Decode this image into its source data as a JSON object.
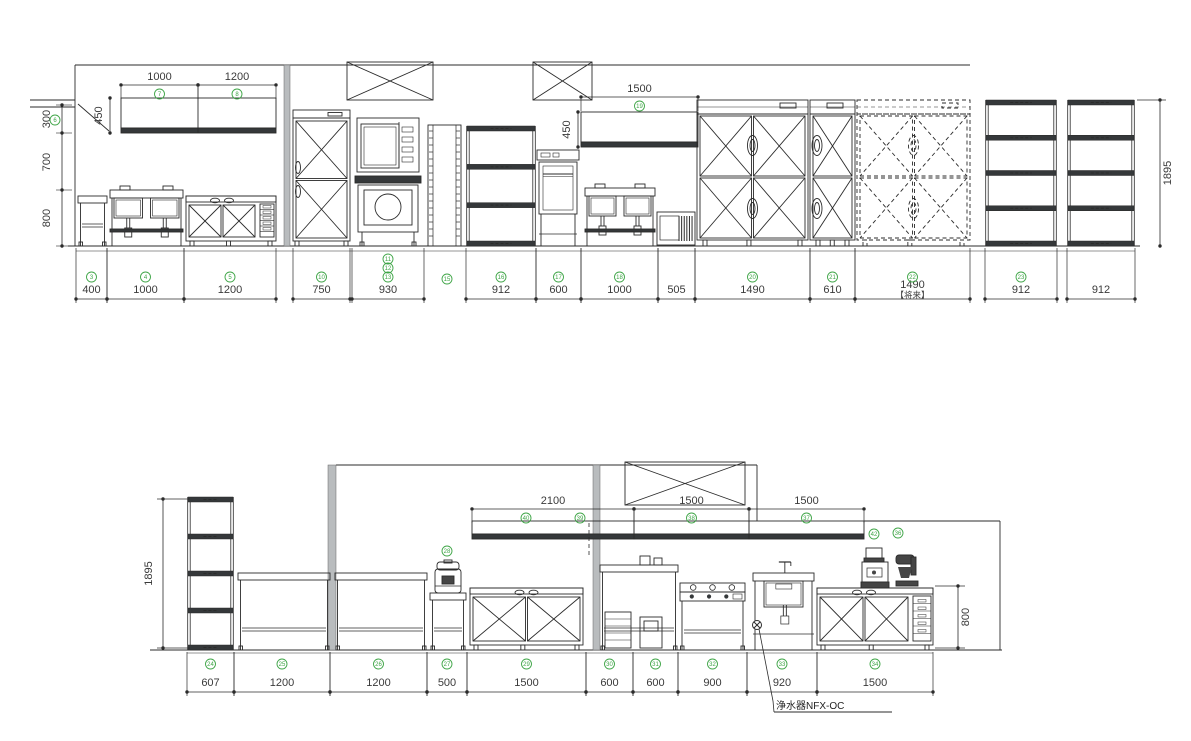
{
  "style": {
    "line_color": "#2b2b2b",
    "dim_text_color": "#3a3a3a",
    "circle_color": "#3fa547",
    "column_fill": "#b9bcbe",
    "band_fill": "#35383a",
    "background": "#ffffff"
  },
  "top_elevation": {
    "floor_y": 246,
    "dims_bottom": {
      "line_y": 299,
      "label_y": 293,
      "circle_y": 277,
      "items": [
        {
          "v": "400",
          "c": [
            "3"
          ],
          "x1": 76,
          "x2": 107
        },
        {
          "v": "1000",
          "c": [
            "4"
          ],
          "x1": 107,
          "x2": 184
        },
        {
          "v": "1200",
          "c": [
            "5"
          ],
          "x1": 184,
          "x2": 276
        },
        {
          "v": "750",
          "c": [
            "10"
          ],
          "x1": 293,
          "x2": 350
        },
        {
          "v": "930",
          "c": [
            "11",
            "12",
            "13"
          ],
          "x1": 352,
          "x2": 424
        },
        {
          "v": "912",
          "c": [
            "16"
          ],
          "x1": 466,
          "x2": 536
        },
        {
          "v": "600",
          "c": [
            "17"
          ],
          "x1": 536,
          "x2": 581
        },
        {
          "v": "1000",
          "c": [
            "18"
          ],
          "x1": 581,
          "x2": 658
        },
        {
          "v": "505",
          "c": [],
          "x1": 658,
          "x2": 695
        },
        {
          "v": "1490",
          "c": [
            "20"
          ],
          "x1": 695,
          "x2": 810
        },
        {
          "v": "610",
          "c": [
            "21"
          ],
          "x1": 810,
          "x2": 855
        },
        {
          "v": "1490",
          "c": [
            "22"
          ],
          "sub": "【将来】",
          "x1": 855,
          "x2": 970
        },
        {
          "v": "912",
          "c": [
            "23"
          ],
          "x1": 985,
          "x2": 1057
        },
        {
          "v": "912",
          "c": [],
          "x1": 1067,
          "x2": 1135
        }
      ]
    },
    "dims_top": [
      {
        "v": "1000",
        "c": [
          "7"
        ],
        "x1": 121,
        "x2": 198,
        "y": 85
      },
      {
        "v": "1200",
        "c": [
          "8"
        ],
        "x1": 198,
        "x2": 276,
        "y": 85
      },
      {
        "v": "1500",
        "c": [
          "19"
        ],
        "x1": 581,
        "x2": 698,
        "y": 97
      }
    ],
    "dims_vertical": [
      {
        "v": "450",
        "x": 110,
        "y1": 98,
        "y2": 133,
        "tx": 102
      },
      {
        "v": "450",
        "x": 578,
        "y1": 112,
        "y2": 147,
        "tx": 570
      },
      {
        "v": "1895",
        "x": 1160,
        "y1": 100,
        "y2": 246,
        "tx": 1171,
        "leaders": [
          [
            1137,
            100,
            1166,
            100
          ]
        ]
      }
    ],
    "chain_left": {
      "x": 62,
      "tx": 50,
      "ticks": [
        105,
        133,
        190,
        246
      ],
      "labels": [
        {
          "v": "300",
          "y": 119
        },
        {
          "v": "700",
          "y": 162
        },
        {
          "v": "800",
          "y": 218
        }
      ]
    },
    "leader_circle": {
      "n": "6",
      "x": 55,
      "y": 120
    },
    "floating_circles": [
      {
        "n": "15",
        "x": 447,
        "y": 279
      }
    ],
    "units": [
      {
        "t": "line",
        "x1": 75,
        "y1": 65,
        "x2": 970,
        "y2": 65
      },
      {
        "t": "line",
        "x1": 75,
        "y1": 65,
        "x2": 75,
        "y2": 246
      },
      {
        "t": "line",
        "x1": 68,
        "y1": 246,
        "x2": 1140,
        "y2": 246
      },
      {
        "t": "line",
        "x1": 76,
        "y1": 251,
        "x2": 1135,
        "y2": 251,
        "lw": 0.6
      },
      {
        "t": "hatch",
        "x": 30,
        "y": 100
      },
      {
        "t": "line",
        "x1": 78,
        "y1": 104,
        "x2": 109,
        "y2": 131
      },
      {
        "t": "wallshelf",
        "x": 121,
        "y": 98,
        "w": 155,
        "h": 35,
        "div": [
          198
        ]
      },
      {
        "t": "table",
        "x": 78,
        "y": 196,
        "w": 29
      },
      {
        "t": "sink2",
        "x": 110,
        "y": 190,
        "w": 73
      },
      {
        "t": "fridgecounter",
        "x": 186,
        "y": 196,
        "w": 90,
        "dw": 18
      },
      {
        "t": "column",
        "x": 284,
        "y": 65,
        "w": 6,
        "h": 181
      },
      {
        "t": "fridgetall",
        "x": 293,
        "y": 110,
        "w": 57
      },
      {
        "t": "hood",
        "x": 347,
        "y": 62,
        "w": 86,
        "h": 38
      },
      {
        "t": "oven",
        "x": 355,
        "y": 118,
        "w": 66
      },
      {
        "t": "platerack",
        "x": 428,
        "y": 125,
        "w": 33,
        "h": 121
      },
      {
        "t": "rack",
        "x": 466,
        "y": 126,
        "w": 70,
        "h": 120,
        "n": 4
      },
      {
        "t": "hood",
        "x": 533,
        "y": 62,
        "w": 59,
        "h": 38
      },
      {
        "t": "dishwasher",
        "x": 537,
        "y": 150,
        "w": 42
      },
      {
        "t": "wallshelf",
        "x": 581,
        "y": 112,
        "w": 117,
        "h": 35,
        "div": []
      },
      {
        "t": "sink2",
        "x": 585,
        "y": 188,
        "w": 70
      },
      {
        "t": "icemaker",
        "x": 657,
        "y": 212,
        "w": 38,
        "h": 33
      },
      {
        "t": "fridge4",
        "x": 697,
        "y": 100,
        "w": 111,
        "cols": 2
      },
      {
        "t": "fridge4",
        "x": 810,
        "y": 100,
        "w": 45,
        "cols": 1
      },
      {
        "t": "fridge4",
        "x": 857,
        "y": 100,
        "w": 113,
        "cols": 2,
        "dashed": true
      },
      {
        "t": "rack",
        "x": 985,
        "y": 100,
        "w": 72,
        "h": 146,
        "n": 5
      },
      {
        "t": "rack",
        "x": 1067,
        "y": 100,
        "w": 68,
        "h": 146,
        "n": 5
      }
    ]
  },
  "bottom_elevation": {
    "floor_y": 650,
    "dims_bottom": {
      "line_y": 692,
      "label_y": 686,
      "circle_y": 664,
      "items": [
        {
          "v": "607",
          "c": [
            "24"
          ],
          "x1": 187,
          "x2": 234
        },
        {
          "v": "1200",
          "c": [
            "25"
          ],
          "x1": 234,
          "x2": 330
        },
        {
          "v": "1200",
          "c": [
            "26"
          ],
          "x1": 330,
          "x2": 427
        },
        {
          "v": "500",
          "c": [
            "27"
          ],
          "x1": 427,
          "x2": 467
        },
        {
          "v": "1500",
          "c": [
            "29"
          ],
          "x1": 467,
          "x2": 586
        },
        {
          "v": "600",
          "c": [
            "30"
          ],
          "x1": 586,
          "x2": 633
        },
        {
          "v": "600",
          "c": [
            "31"
          ],
          "x1": 633,
          "x2": 678
        },
        {
          "v": "900",
          "c": [
            "32"
          ],
          "x1": 678,
          "x2": 747
        },
        {
          "v": "920",
          "c": [
            "33"
          ],
          "x1": 747,
          "x2": 817
        },
        {
          "v": "1500",
          "c": [
            "34"
          ],
          "x1": 817,
          "x2": 933
        }
      ]
    },
    "dims_top": [
      {
        "v": "2100",
        "c": [
          "40",
          "39"
        ],
        "x1": 472,
        "x2": 634,
        "y": 509
      },
      {
        "v": "1500",
        "c": [
          "38"
        ],
        "x1": 634,
        "x2": 749,
        "y": 509
      },
      {
        "v": "1500",
        "c": [
          "37"
        ],
        "x1": 749,
        "x2": 864,
        "y": 509
      }
    ],
    "dims_vertical": [
      {
        "v": "1895",
        "x": 163,
        "y1": 499,
        "y2": 648,
        "tx": 152,
        "leaders": [
          [
            157,
            499,
            190,
            499
          ],
          [
            157,
            648,
            190,
            648
          ]
        ]
      },
      {
        "v": "800",
        "x": 958,
        "y1": 586,
        "y2": 648,
        "tx": 969,
        "leaders": [
          [
            935,
            586,
            965,
            586
          ],
          [
            935,
            648,
            965,
            648
          ]
        ]
      }
    ],
    "floating_circles": [
      {
        "n": "28",
        "x": 447,
        "y": 551
      },
      {
        "n": "42",
        "x": 874,
        "y": 534
      },
      {
        "n": "36",
        "x": 898,
        "y": 533
      }
    ],
    "note": {
      "text": "浄水器NFX-OC",
      "x": 776,
      "y": 709,
      "underline": [
        774,
        712,
        892,
        712
      ],
      "leader": [
        [
          759,
          629
        ],
        [
          773,
          701
        ]
      ],
      "symbol": {
        "x": 757,
        "y": 625
      }
    },
    "units": [
      {
        "t": "line",
        "x1": 336,
        "y1": 465,
        "x2": 757,
        "y2": 465
      },
      {
        "t": "line",
        "x1": 757,
        "y1": 465,
        "x2": 757,
        "y2": 521
      },
      {
        "t": "line",
        "x1": 150,
        "y1": 650,
        "x2": 1002,
        "y2": 650
      },
      {
        "t": "line",
        "x1": 187,
        "y1": 653,
        "x2": 933,
        "y2": 653,
        "lw": 0.6
      },
      {
        "t": "line",
        "x1": 864,
        "y1": 521,
        "x2": 1000,
        "y2": 521
      },
      {
        "t": "line",
        "x1": 1000,
        "y1": 521,
        "x2": 1000,
        "y2": 650
      },
      {
        "t": "column",
        "x": 328,
        "y": 465,
        "w": 8,
        "h": 185
      },
      {
        "t": "column",
        "x": 593,
        "y": 465,
        "w": 7,
        "h": 185
      },
      {
        "t": "rack",
        "x": 187,
        "y": 497,
        "w": 47,
        "h": 153,
        "n": 5
      },
      {
        "t": "table",
        "x": 238,
        "y": 573,
        "w": 92
      },
      {
        "t": "table",
        "x": 335,
        "y": 573,
        "w": 92
      },
      {
        "t": "table",
        "x": 430,
        "y": 593,
        "w": 36
      },
      {
        "t": "ricecooker",
        "x": 434,
        "y": 560,
        "w": 28,
        "h": 33
      },
      {
        "t": "fridgecounter",
        "x": 470,
        "y": 588,
        "w": 113,
        "dw": 0
      },
      {
        "t": "table",
        "x": 600,
        "y": 565,
        "w": 78,
        "boxes": true
      },
      {
        "t": "range",
        "x": 678,
        "y": 583,
        "w": 69
      },
      {
        "t": "sinkbig",
        "x": 750,
        "y": 568,
        "w": 67
      },
      {
        "t": "fridgecounter",
        "x": 817,
        "y": 588,
        "w": 116,
        "dw": 22
      },
      {
        "t": "foodprocessor",
        "x": 862,
        "y": 548,
        "w": 30,
        "h": 40
      },
      {
        "t": "mixer",
        "x": 896,
        "y": 553,
        "w": 26,
        "h": 35
      },
      {
        "t": "hood",
        "x": 625,
        "y": 462,
        "w": 120,
        "h": 43
      },
      {
        "t": "wallshelf",
        "x": 472,
        "y": 521,
        "w": 162,
        "h": 18,
        "div": []
      },
      {
        "t": "wallshelf",
        "x": 634,
        "y": 521,
        "w": 115,
        "h": 18,
        "div": []
      },
      {
        "t": "wallshelf",
        "x": 749,
        "y": 521,
        "w": 115,
        "h": 18,
        "div": []
      },
      {
        "t": "dashv",
        "x": 589,
        "y1": 523,
        "y2": 556
      }
    ]
  }
}
